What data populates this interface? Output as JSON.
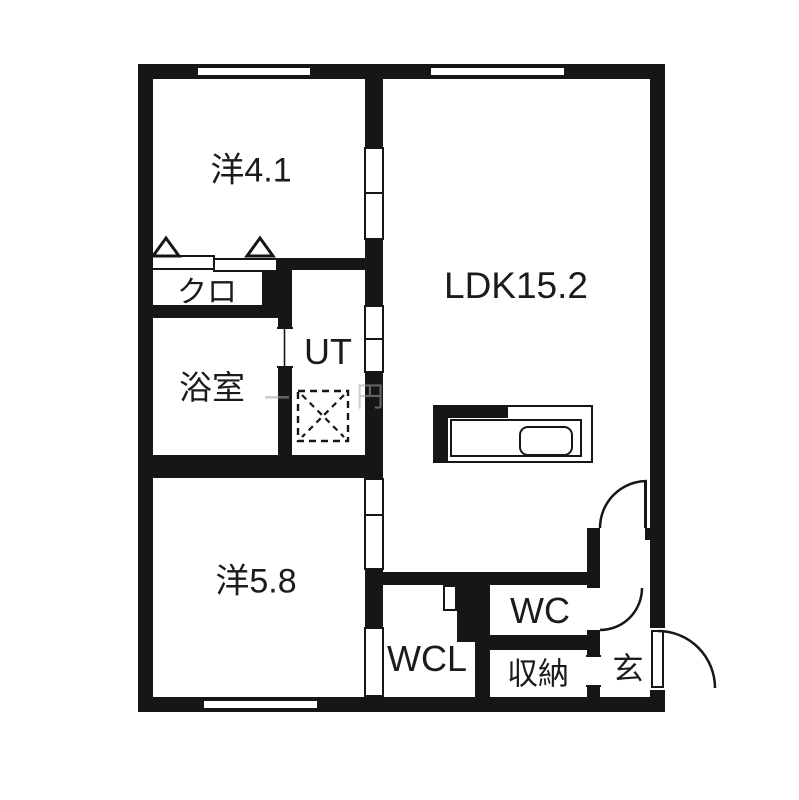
{
  "plan": {
    "type": "floor-plan",
    "rooms": {
      "yo41": {
        "label": "洋4.1"
      },
      "kuro": {
        "label": "クロ"
      },
      "bath": {
        "label": "浴室"
      },
      "ut": {
        "label": "UT"
      },
      "ldk": {
        "label": "LDK15.2"
      },
      "yo58": {
        "label": "洋5.8"
      },
      "wcl": {
        "label": "WCL"
      },
      "wc": {
        "label": "WC"
      },
      "storage": {
        "label": "収納"
      },
      "entry": {
        "label": "玄"
      }
    },
    "watermark": {
      "left_char": "ー",
      "right_char": "円"
    },
    "colors": {
      "wall": "#161616",
      "floor": "#ffffff",
      "watermark": "#ababab"
    }
  }
}
